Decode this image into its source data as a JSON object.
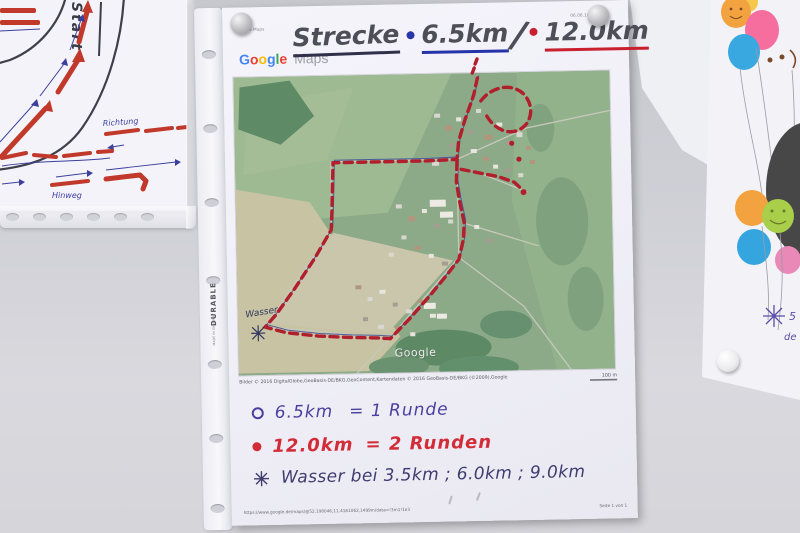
{
  "photo": {
    "wall_color": "#cfcfd6"
  },
  "left_note": {
    "start_label": "Start",
    "direction_label": "Richtung",
    "away_label": "Hinweg"
  },
  "sleeve": {
    "brand": "DURABLE",
    "origin": "MADE IN GERMANY"
  },
  "page": {
    "header_left": "Google Maps",
    "date": "06.06.16",
    "logo": {
      "letters": [
        {
          "ch": "G",
          "color": "#4285F4"
        },
        {
          "ch": "o",
          "color": "#EA4335"
        },
        {
          "ch": "o",
          "color": "#FBBC05"
        },
        {
          "ch": "g",
          "color": "#4285F4"
        },
        {
          "ch": "l",
          "color": "#34A853"
        },
        {
          "ch": "e",
          "color": "#EA4335"
        }
      ],
      "suffix": "Maps"
    },
    "title": {
      "word": "Strecke",
      "distance_short": "6.5km",
      "separator": "/",
      "distance_long": "12.0km"
    },
    "map": {
      "watermark": "Google",
      "water_label": "Wasser",
      "credits": "Bilder © 2016 DigitalGlobe,GeoBasis-DE/BKG,GeoContent,Kartendaten © 2016 GeoBasis-DE/BKG (©2009),Google",
      "scale_label": "100 m",
      "route_red": "#b11f2c",
      "route_blue": "#3b4b9b"
    },
    "notes": {
      "line1": {
        "distance": "6.5km",
        "equals": "= 1 Runde"
      },
      "line2": {
        "distance": "12.0km",
        "equals": "= 2 Runden"
      },
      "line3": {
        "text": "Wasser bei 3.5km ; 6.0km ; 9.0km"
      }
    },
    "footer": {
      "url": "https://www.google.de/maps/@52.198046,11.4161062,1499m/data=!3m1!1e3",
      "page_info": "Seite 1 von 1"
    }
  },
  "right_note": {
    "fragment_top": "5",
    "fragment_bottom": "de"
  }
}
